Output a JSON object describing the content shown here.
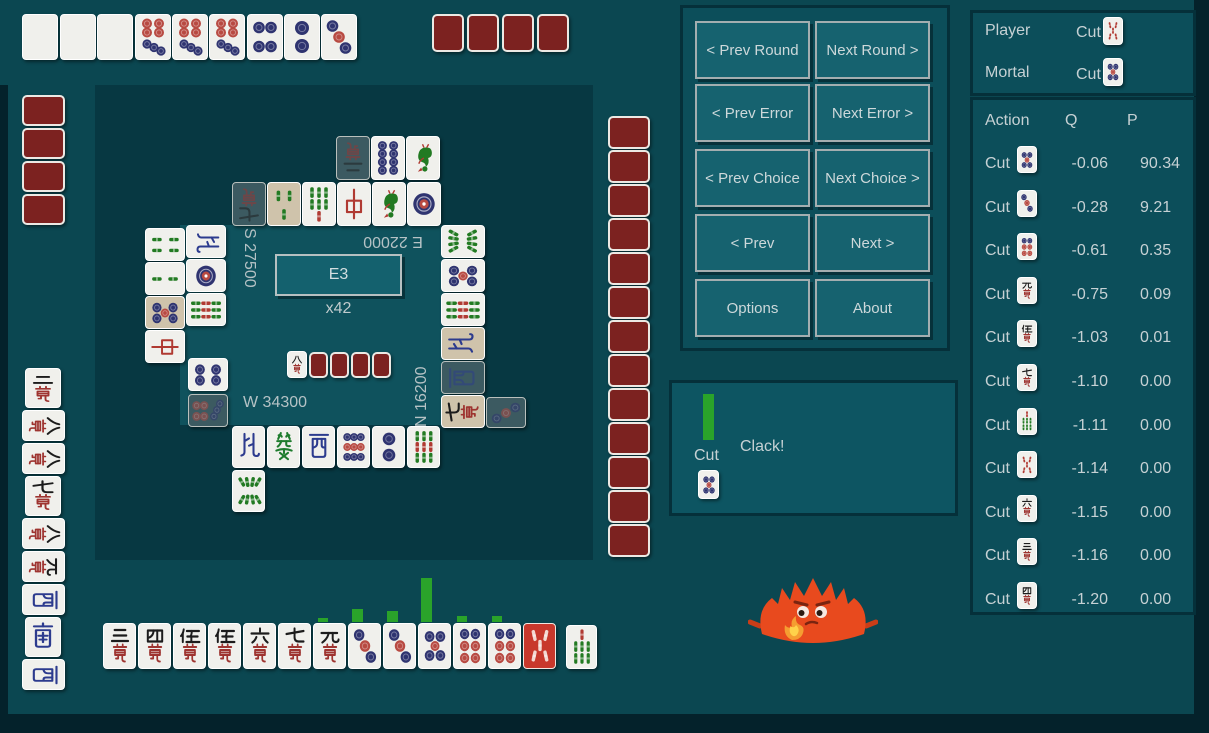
{
  "colors": {
    "page_bg": "#0b4751",
    "board_bg": "#073842",
    "center_bg": "#0f525d",
    "panel_bg": "#0c4e5a",
    "button_bg": "#16626f",
    "tile_back": "#7c2220",
    "bar_green": "#2aa32a",
    "aka_red": "#c8382c",
    "text": "#c6d1d4"
  },
  "board": {
    "round_label": "E3",
    "wall_label": "x42",
    "scores": [
      {
        "id": "south-left",
        "text": "S 27500"
      },
      {
        "id": "east-top",
        "text": "E 22000"
      },
      {
        "id": "west-bottom",
        "text": "W 34300"
      },
      {
        "id": "north-right",
        "text": "N 16200"
      }
    ],
    "dora_indicator": "8m",
    "bars": [
      {
        "x": 318,
        "w": 10,
        "h": 4
      },
      {
        "x": 352,
        "w": 11,
        "h": 13
      },
      {
        "x": 387,
        "w": 11,
        "h": 11
      },
      {
        "x": 421,
        "w": 11,
        "h": 44
      },
      {
        "x": 457,
        "w": 10,
        "h": 6
      },
      {
        "x": 492,
        "w": 10,
        "h": 6
      }
    ],
    "tiles": [
      {
        "c": "blk",
        "x": 22,
        "y": 14,
        "w": 36,
        "h": 46,
        "r": 180
      },
      {
        "c": "blk",
        "x": 60,
        "y": 14,
        "w": 36,
        "h": 46,
        "r": 180
      },
      {
        "c": "blk",
        "x": 97,
        "y": 14,
        "w": 36,
        "h": 46,
        "r": 180
      },
      {
        "c": "7p",
        "x": 135,
        "y": 14,
        "w": 36,
        "h": 46,
        "r": 180
      },
      {
        "c": "7p",
        "x": 172,
        "y": 14,
        "w": 36,
        "h": 46,
        "r": 180
      },
      {
        "c": "7p",
        "x": 209,
        "y": 14,
        "w": 36,
        "h": 46,
        "r": 180
      },
      {
        "c": "4p",
        "x": 247,
        "y": 14,
        "w": 36,
        "h": 46,
        "r": 180
      },
      {
        "c": "2p",
        "x": 284,
        "y": 14,
        "w": 36,
        "h": 46,
        "r": 180
      },
      {
        "c": "3p",
        "x": 321,
        "y": 14,
        "w": 36,
        "h": 46,
        "r": 180
      },
      {
        "c": "bk",
        "x": 432,
        "y": 14,
        "w": 32,
        "h": 38
      },
      {
        "c": "bk",
        "x": 467,
        "y": 14,
        "w": 32,
        "h": 38
      },
      {
        "c": "bk",
        "x": 502,
        "y": 14,
        "w": 32,
        "h": 38
      },
      {
        "c": "bk",
        "x": 537,
        "y": 14,
        "w": 32,
        "h": 38
      },
      {
        "c": "bk",
        "x": 22,
        "y": 95,
        "w": 43,
        "h": 31
      },
      {
        "c": "bk",
        "x": 22,
        "y": 128,
        "w": 43,
        "h": 31
      },
      {
        "c": "bk",
        "x": 22,
        "y": 161,
        "w": 43,
        "h": 31
      },
      {
        "c": "bk",
        "x": 22,
        "y": 194,
        "w": 43,
        "h": 31
      },
      {
        "c": "2m",
        "x": 25,
        "y": 368,
        "w": 36,
        "h": 40
      },
      {
        "c": "8m",
        "x": 22,
        "y": 410,
        "w": 43,
        "h": 31,
        "r": 90
      },
      {
        "c": "8m",
        "x": 22,
        "y": 443,
        "w": 43,
        "h": 31,
        "r": 90
      },
      {
        "c": "7m",
        "x": 25,
        "y": 476,
        "w": 36,
        "h": 40
      },
      {
        "c": "8m",
        "x": 22,
        "y": 518,
        "w": 43,
        "h": 31,
        "r": 90
      },
      {
        "c": "9m",
        "x": 22,
        "y": 551,
        "w": 43,
        "h": 31,
        "r": 90
      },
      {
        "c": "W",
        "x": 22,
        "y": 584,
        "w": 43,
        "h": 31,
        "r": 90
      },
      {
        "c": "S",
        "x": 25,
        "y": 617,
        "w": 36,
        "h": 40
      },
      {
        "c": "W",
        "x": 22,
        "y": 659,
        "w": 43,
        "h": 31,
        "r": 90
      },
      {
        "c": "2m",
        "x": 336,
        "y": 136,
        "w": 34,
        "h": 44,
        "r": 180,
        "v": "d"
      },
      {
        "c": "8p",
        "x": 371,
        "y": 136,
        "w": 34,
        "h": 44,
        "r": 180
      },
      {
        "c": "1s",
        "x": 406,
        "y": 136,
        "w": 34,
        "h": 44,
        "r": 180
      },
      {
        "c": "7m",
        "x": 232,
        "y": 182,
        "w": 34,
        "h": 44,
        "r": 180,
        "v": "d"
      },
      {
        "c": "3s",
        "x": 267,
        "y": 182,
        "w": 34,
        "h": 44,
        "r": 180,
        "v": "t"
      },
      {
        "c": "7s",
        "x": 302,
        "y": 182,
        "w": 34,
        "h": 44,
        "r": 180
      },
      {
        "c": "C",
        "x": 337,
        "y": 182,
        "w": 34,
        "h": 44,
        "r": 180
      },
      {
        "c": "1s",
        "x": 372,
        "y": 182,
        "w": 34,
        "h": 44,
        "r": 180
      },
      {
        "c": "1p",
        "x": 407,
        "y": 182,
        "w": 34,
        "h": 44,
        "r": 180
      },
      {
        "c": "4s",
        "x": 145,
        "y": 228,
        "w": 40,
        "h": 33,
        "r": 90
      },
      {
        "c": "2s",
        "x": 145,
        "y": 262,
        "w": 40,
        "h": 33,
        "r": 90
      },
      {
        "c": "5p",
        "x": 145,
        "y": 296,
        "w": 40,
        "h": 33,
        "r": 90,
        "v": "t"
      },
      {
        "c": "C",
        "x": 145,
        "y": 330,
        "w": 40,
        "h": 33,
        "r": 90
      },
      {
        "c": "N",
        "x": 186,
        "y": 225,
        "w": 40,
        "h": 33,
        "r": 90
      },
      {
        "c": "1p",
        "x": 186,
        "y": 259,
        "w": 40,
        "h": 33,
        "r": 90
      },
      {
        "c": "9s",
        "x": 186,
        "y": 293,
        "w": 40,
        "h": 33,
        "r": 90
      },
      {
        "c": "4p",
        "x": 188,
        "y": 358,
        "w": 40,
        "h": 33,
        "r": 90
      },
      {
        "c": "7p",
        "x": 188,
        "y": 394,
        "w": 40,
        "h": 33,
        "r": 90,
        "v": "d"
      },
      {
        "c": "8s",
        "x": 441,
        "y": 225,
        "w": 44,
        "h": 33,
        "r": 270
      },
      {
        "c": "5p",
        "x": 441,
        "y": 259,
        "w": 44,
        "h": 33,
        "r": 270
      },
      {
        "c": "9s",
        "x": 441,
        "y": 293,
        "w": 44,
        "h": 33,
        "r": 270
      },
      {
        "c": "N",
        "x": 441,
        "y": 327,
        "w": 44,
        "h": 33,
        "r": 270,
        "v": "t"
      },
      {
        "c": "W",
        "x": 441,
        "y": 361,
        "w": 44,
        "h": 33,
        "r": 270,
        "v": "d"
      },
      {
        "c": "7m",
        "x": 441,
        "y": 395,
        "w": 44,
        "h": 33,
        "r": 270,
        "v": "t"
      },
      {
        "c": "3p",
        "x": 486,
        "y": 397,
        "w": 40,
        "h": 31,
        "r": 270,
        "v": "d"
      },
      {
        "c": "N",
        "x": 232,
        "y": 426,
        "w": 33,
        "h": 42
      },
      {
        "c": "F",
        "x": 267,
        "y": 426,
        "w": 33,
        "h": 42
      },
      {
        "c": "W",
        "x": 302,
        "y": 426,
        "w": 33,
        "h": 42
      },
      {
        "c": "9p",
        "x": 337,
        "y": 426,
        "w": 33,
        "h": 42
      },
      {
        "c": "2p",
        "x": 372,
        "y": 426,
        "w": 33,
        "h": 42
      },
      {
        "c": "9s",
        "x": 407,
        "y": 426,
        "w": 33,
        "h": 42
      },
      {
        "c": "8s",
        "x": 232,
        "y": 470,
        "w": 33,
        "h": 42
      },
      {
        "c": "8m",
        "x": 287,
        "y": 351,
        "w": 20,
        "h": 27
      },
      {
        "c": "bk",
        "x": 309,
        "y": 352,
        "w": 19,
        "h": 26
      },
      {
        "c": "bk",
        "x": 330,
        "y": 352,
        "w": 19,
        "h": 26
      },
      {
        "c": "bk",
        "x": 351,
        "y": 352,
        "w": 19,
        "h": 26
      },
      {
        "c": "bk",
        "x": 372,
        "y": 352,
        "w": 19,
        "h": 26
      },
      {
        "c": "bk",
        "x": 608,
        "y": 116,
        "w": 42,
        "h": 33
      },
      {
        "c": "bk",
        "x": 608,
        "y": 150,
        "w": 42,
        "h": 33
      },
      {
        "c": "bk",
        "x": 608,
        "y": 184,
        "w": 42,
        "h": 33
      },
      {
        "c": "bk",
        "x": 608,
        "y": 218,
        "w": 42,
        "h": 33
      },
      {
        "c": "bk",
        "x": 608,
        "y": 252,
        "w": 42,
        "h": 33
      },
      {
        "c": "bk",
        "x": 608,
        "y": 286,
        "w": 42,
        "h": 33
      },
      {
        "c": "bk",
        "x": 608,
        "y": 320,
        "w": 42,
        "h": 33
      },
      {
        "c": "bk",
        "x": 608,
        "y": 354,
        "w": 42,
        "h": 33
      },
      {
        "c": "bk",
        "x": 608,
        "y": 388,
        "w": 42,
        "h": 33
      },
      {
        "c": "bk",
        "x": 608,
        "y": 422,
        "w": 42,
        "h": 33
      },
      {
        "c": "bk",
        "x": 608,
        "y": 456,
        "w": 42,
        "h": 33
      },
      {
        "c": "bk",
        "x": 608,
        "y": 490,
        "w": 42,
        "h": 33
      },
      {
        "c": "bk",
        "x": 608,
        "y": 524,
        "w": 42,
        "h": 33
      },
      {
        "c": "3m",
        "x": 103,
        "y": 623,
        "w": 33,
        "h": 46
      },
      {
        "c": "4m",
        "x": 138,
        "y": 623,
        "w": 33,
        "h": 46
      },
      {
        "c": "5m",
        "x": 173,
        "y": 623,
        "w": 33,
        "h": 46
      },
      {
        "c": "5m",
        "x": 208,
        "y": 623,
        "w": 33,
        "h": 46
      },
      {
        "c": "6m",
        "x": 243,
        "y": 623,
        "w": 33,
        "h": 46
      },
      {
        "c": "7m",
        "x": 278,
        "y": 623,
        "w": 33,
        "h": 46
      },
      {
        "c": "9m",
        "x": 313,
        "y": 623,
        "w": 33,
        "h": 46
      },
      {
        "c": "3p",
        "x": 348,
        "y": 623,
        "w": 33,
        "h": 46
      },
      {
        "c": "3p",
        "x": 383,
        "y": 623,
        "w": 33,
        "h": 46
      },
      {
        "c": "5p",
        "x": 418,
        "y": 623,
        "w": 33,
        "h": 46
      },
      {
        "c": "6p",
        "x": 453,
        "y": 623,
        "w": 33,
        "h": 46
      },
      {
        "c": "6p",
        "x": 488,
        "y": 623,
        "w": 33,
        "h": 46
      },
      {
        "c": "r5s",
        "x": 523,
        "y": 623,
        "w": 33,
        "h": 46,
        "v": "a"
      },
      {
        "c": "7s",
        "x": 566,
        "y": 625,
        "w": 31,
        "h": 44
      }
    ]
  },
  "controls": {
    "buttons": [
      {
        "id": "prev-round",
        "label": "< Prev Round"
      },
      {
        "id": "next-round",
        "label": "Next Round >"
      },
      {
        "id": "prev-error",
        "label": "< Prev Error"
      },
      {
        "id": "next-error",
        "label": "Next Error >"
      },
      {
        "id": "prev-choice",
        "label": "< Prev Choice"
      },
      {
        "id": "next-choice",
        "label": "Next Choice >"
      },
      {
        "id": "prev",
        "label": "< Prev"
      },
      {
        "id": "next",
        "label": "Next >"
      },
      {
        "id": "options",
        "label": "Options"
      },
      {
        "id": "about",
        "label": "About"
      }
    ]
  },
  "comparison": {
    "player_label": "Player",
    "player_action_label": "Cut",
    "player_tile": "r5s",
    "mortal_label": "Mortal",
    "mortal_action_label": "Cut",
    "mortal_tile": "5p"
  },
  "action_table": {
    "headers": {
      "action": "Action",
      "q": "Q",
      "p": "P"
    },
    "rows": [
      {
        "action": "Cut",
        "tile": "5p",
        "q": "-0.06",
        "p": "90.34"
      },
      {
        "action": "Cut",
        "tile": "3p",
        "q": "-0.28",
        "p": "9.21"
      },
      {
        "action": "Cut",
        "tile": "6p",
        "q": "-0.61",
        "p": "0.35"
      },
      {
        "action": "Cut",
        "tile": "9m",
        "q": "-0.75",
        "p": "0.09"
      },
      {
        "action": "Cut",
        "tile": "5m",
        "q": "-1.03",
        "p": "0.01"
      },
      {
        "action": "Cut",
        "tile": "7m",
        "q": "-1.10",
        "p": "0.00"
      },
      {
        "action": "Cut",
        "tile": "7s",
        "q": "-1.11",
        "p": "0.00"
      },
      {
        "action": "Cut",
        "tile": "r5s",
        "q": "-1.14",
        "p": "0.00"
      },
      {
        "action": "Cut",
        "tile": "6m",
        "q": "-1.15",
        "p": "0.00"
      },
      {
        "action": "Cut",
        "tile": "3m",
        "q": "-1.16",
        "p": "0.00"
      },
      {
        "action": "Cut",
        "tile": "4m",
        "q": "-1.20",
        "p": "0.00"
      }
    ]
  },
  "event_panel": {
    "action_label": "Cut",
    "tile": "5p",
    "message": "Clack!"
  },
  "mascot_icon": "thinking-crab-icon"
}
